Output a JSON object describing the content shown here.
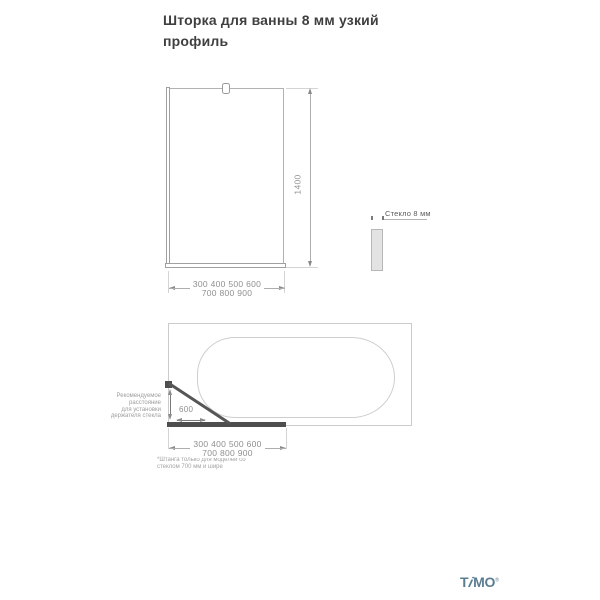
{
  "title": {
    "line1": "Шторка для ванны 8 мм узкий",
    "line2": "профиль"
  },
  "front_view": {
    "height_dim": "1400",
    "width_dims": [
      "300 400 500 600",
      "700 800 900"
    ]
  },
  "glass_section": {
    "label": "Стекло 8 мм"
  },
  "top_view": {
    "holder_distance": "600",
    "note_lines": [
      "Рекомендуемое",
      "расстояние",
      "для установки",
      "держателя стекла"
    ],
    "width_dims": [
      "300 400 500 600",
      "700 800 900"
    ],
    "footnote": [
      "*Штанга только для моделей со",
      "стеклом 700 мм и шире"
    ]
  },
  "footer": {
    "brand_t": "T",
    "brand_i": "i",
    "brand_mo": "MO",
    "registered": "®"
  },
  "colors": {
    "brand": "#5b7d91",
    "dark_element": "#4e4e4e",
    "outline": "#b2b2b2",
    "dim_text": "#8f8f8f"
  }
}
